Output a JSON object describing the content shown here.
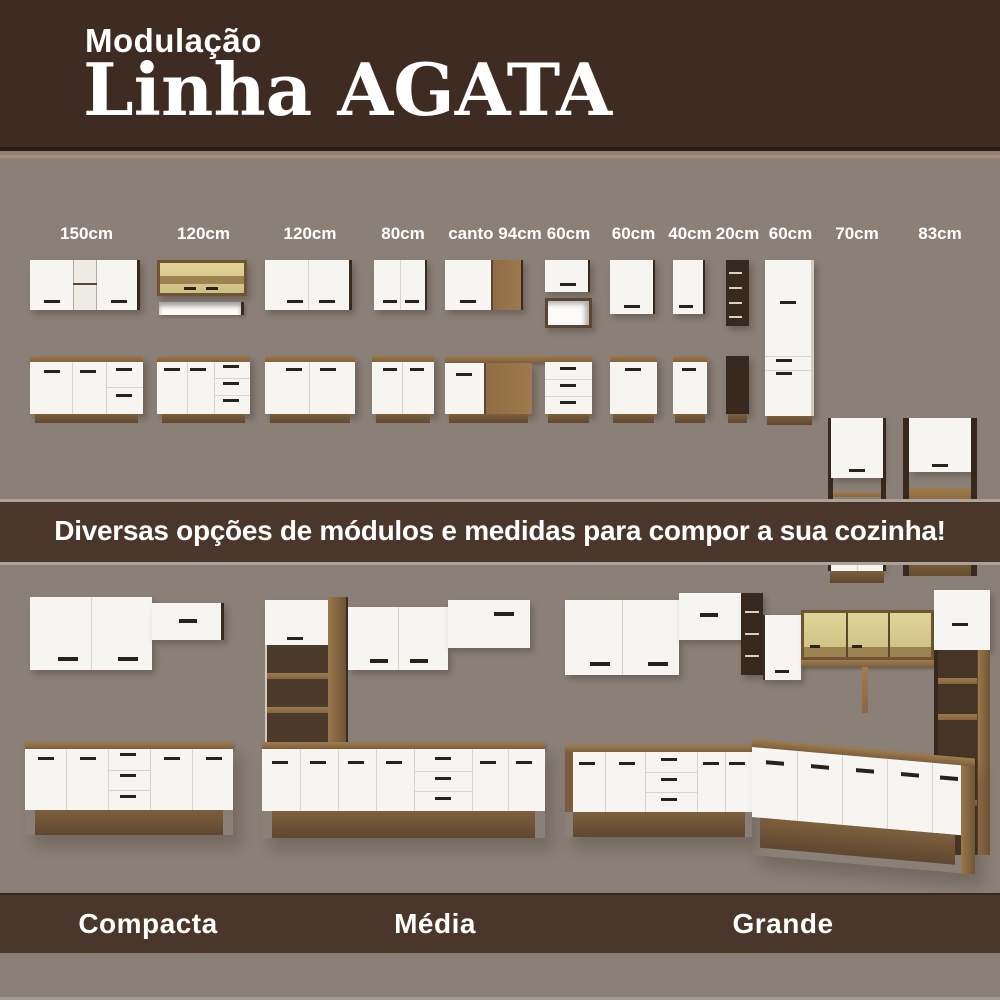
{
  "header": {
    "kicker": "Modulação",
    "title": "Linha AGATA"
  },
  "modules": {
    "items": [
      {
        "label": "150cm"
      },
      {
        "label": "120cm"
      },
      {
        "label": "120cm"
      },
      {
        "label": "80cm"
      },
      {
        "label": "canto 94cm"
      },
      {
        "label": "60cm"
      },
      {
        "label": "60cm"
      },
      {
        "label": "40cm"
      },
      {
        "label": "20cm"
      },
      {
        "label": "60cm"
      },
      {
        "label": "70cm"
      },
      {
        "label": "83cm"
      }
    ]
  },
  "banner": {
    "text": "Diversas opções de módulos e medidas para compor a sua cozinha!"
  },
  "kitchens": {
    "items": [
      {
        "name": "Compacta"
      },
      {
        "name": "Média"
      },
      {
        "name": "Grande"
      }
    ]
  },
  "colors": {
    "brown_dark": "#3E2C23",
    "brown_band": "#4A362B",
    "bg_gray": "#8B8078",
    "door_white": "#F7F5F1",
    "frame_dark": "#38291F",
    "wood": "#8F6C44",
    "wood_dark": "#6F5536",
    "glass": "#D6C88C",
    "handle": "#26221E",
    "line_light": "#ABA29A",
    "text_white": "#FFFFFF"
  }
}
